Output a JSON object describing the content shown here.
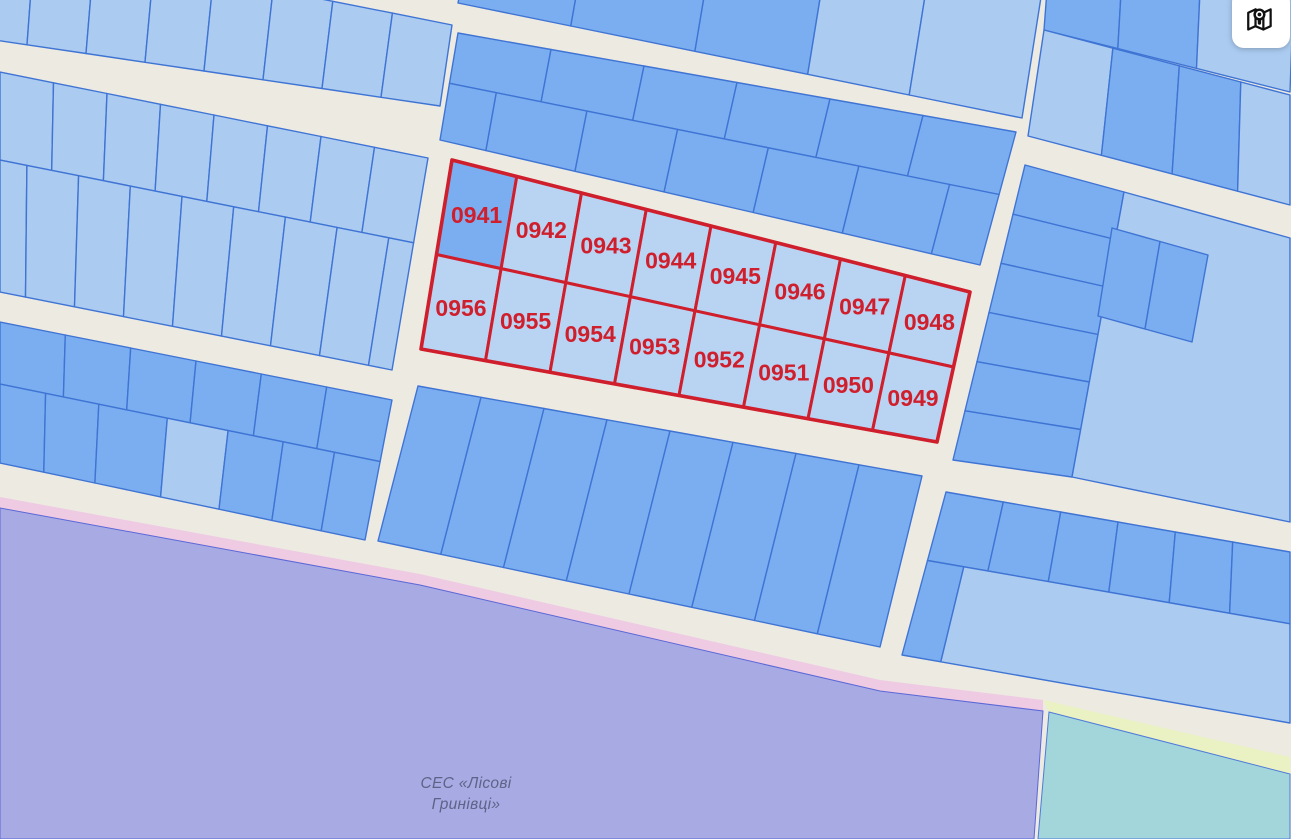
{
  "map": {
    "selected_parcels": {
      "top_row": [
        "0941",
        "0942",
        "0943",
        "0944",
        "0945",
        "0946",
        "0947",
        "0948"
      ],
      "bottom_row": [
        "0956",
        "0955",
        "0954",
        "0953",
        "0952",
        "0951",
        "0950",
        "0949"
      ]
    },
    "area_label": {
      "line1": "СЕС «Лісові",
      "line2": "Гринівці»"
    },
    "controls": {
      "map_button_icon": "map-pin-icon"
    },
    "palette": {
      "road": "#edeae1",
      "light": "#abcbf1",
      "pale": "#b9d3f3",
      "medium": "#7aaef0",
      "parcel_border": "#3f74d4",
      "selection_red": "#d01f2c",
      "purple": "#a7aae3",
      "purple_border": "#5b67d8",
      "pink": "#eecbe2",
      "yellow": "#eaf2c4",
      "cyan": "#a2d6db",
      "cyan_border": "#4f7bd9",
      "area_text": "#5d6387"
    }
  }
}
